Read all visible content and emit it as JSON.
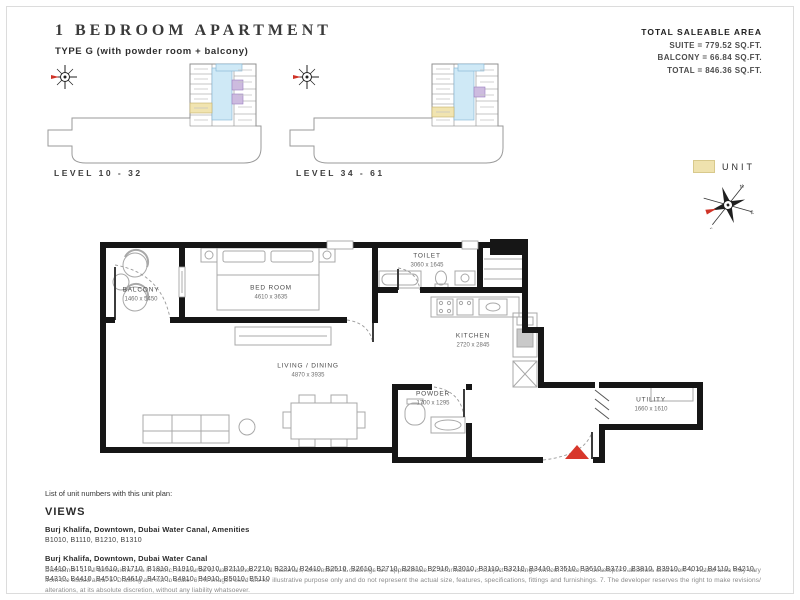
{
  "header": {
    "title": "1 BEDROOM APARTMENT",
    "subtitle": "TYPE G (with powder room + balcony)",
    "area": {
      "heading": "TOTAL SALEABLE AREA",
      "suite": "SUITE = 779.52 SQ.FT.",
      "balcony": "BALCONY = 66.84 SQ.FT.",
      "total": "TOTAL = 846.36 SQ.FT."
    }
  },
  "key_plans": [
    {
      "label": "LEVEL 10 - 32"
    },
    {
      "label": "LEVEL 34 - 61"
    }
  ],
  "legend": {
    "unit_label": "UNIT",
    "unit_color": "#efe2ae"
  },
  "floor_plan": {
    "rooms": [
      {
        "name": "BALCONY",
        "dims": "1460 x 5450"
      },
      {
        "name": "BED ROOM",
        "dims": "4610 x 3635"
      },
      {
        "name": "LIVING / DINING",
        "dims": "4870 x 3935"
      },
      {
        "name": "TOILET",
        "dims": "3060 x 1645"
      },
      {
        "name": "KITCHEN",
        "dims": "2720 x 2845"
      },
      {
        "name": "POWDER",
        "dims": "1700 x 1295"
      },
      {
        "name": "UTILITY",
        "dims": "1660 x 1610"
      }
    ],
    "entrance_marker_color": "#d8372b"
  },
  "unit_list": {
    "intro": "List of unit numbers with this unit plan:",
    "views_heading": "VIEWS",
    "groups": [
      {
        "view": "Burj Khalifa, Downtown, Dubai Water Canal, Amenities",
        "units": "B1010, B1110, B1210, B1310"
      },
      {
        "view": "Burj Khalifa, Downtown, Dubai Water Canal",
        "units": "B1410, B1510, B1610, B1710, B1810, B1910, B2010, B2110, B2210, B2310, B2410, B2510, B2610, B2710, B2810, B2910, B3010, B3110, B3210, B3410, B3510, B3610, B3710, B3810, B3910, B4010, B4110, B4210, B4310, B4410, B4510, B4610, B4710, B4810, B4910, B5010, B5110"
      }
    ]
  },
  "disclaimer": "Disclaimer: 1. All dimensions are in metric, measured to wall finishes. 2. All materials, dimensions & drawings are approximate. 3. Information is subject to change without notice, at developer's absolute discretion. 4. Actual area may vary from the stated area. 5. Drawing are not to scale. 6. All images used are for illustrative purpose only and do not represent the actual size, features, specifications, fittings and furnishings. 7. The developer reserves the right to make revisions/ alterations, at its absolute discretion, without any liability whatsoever."
}
